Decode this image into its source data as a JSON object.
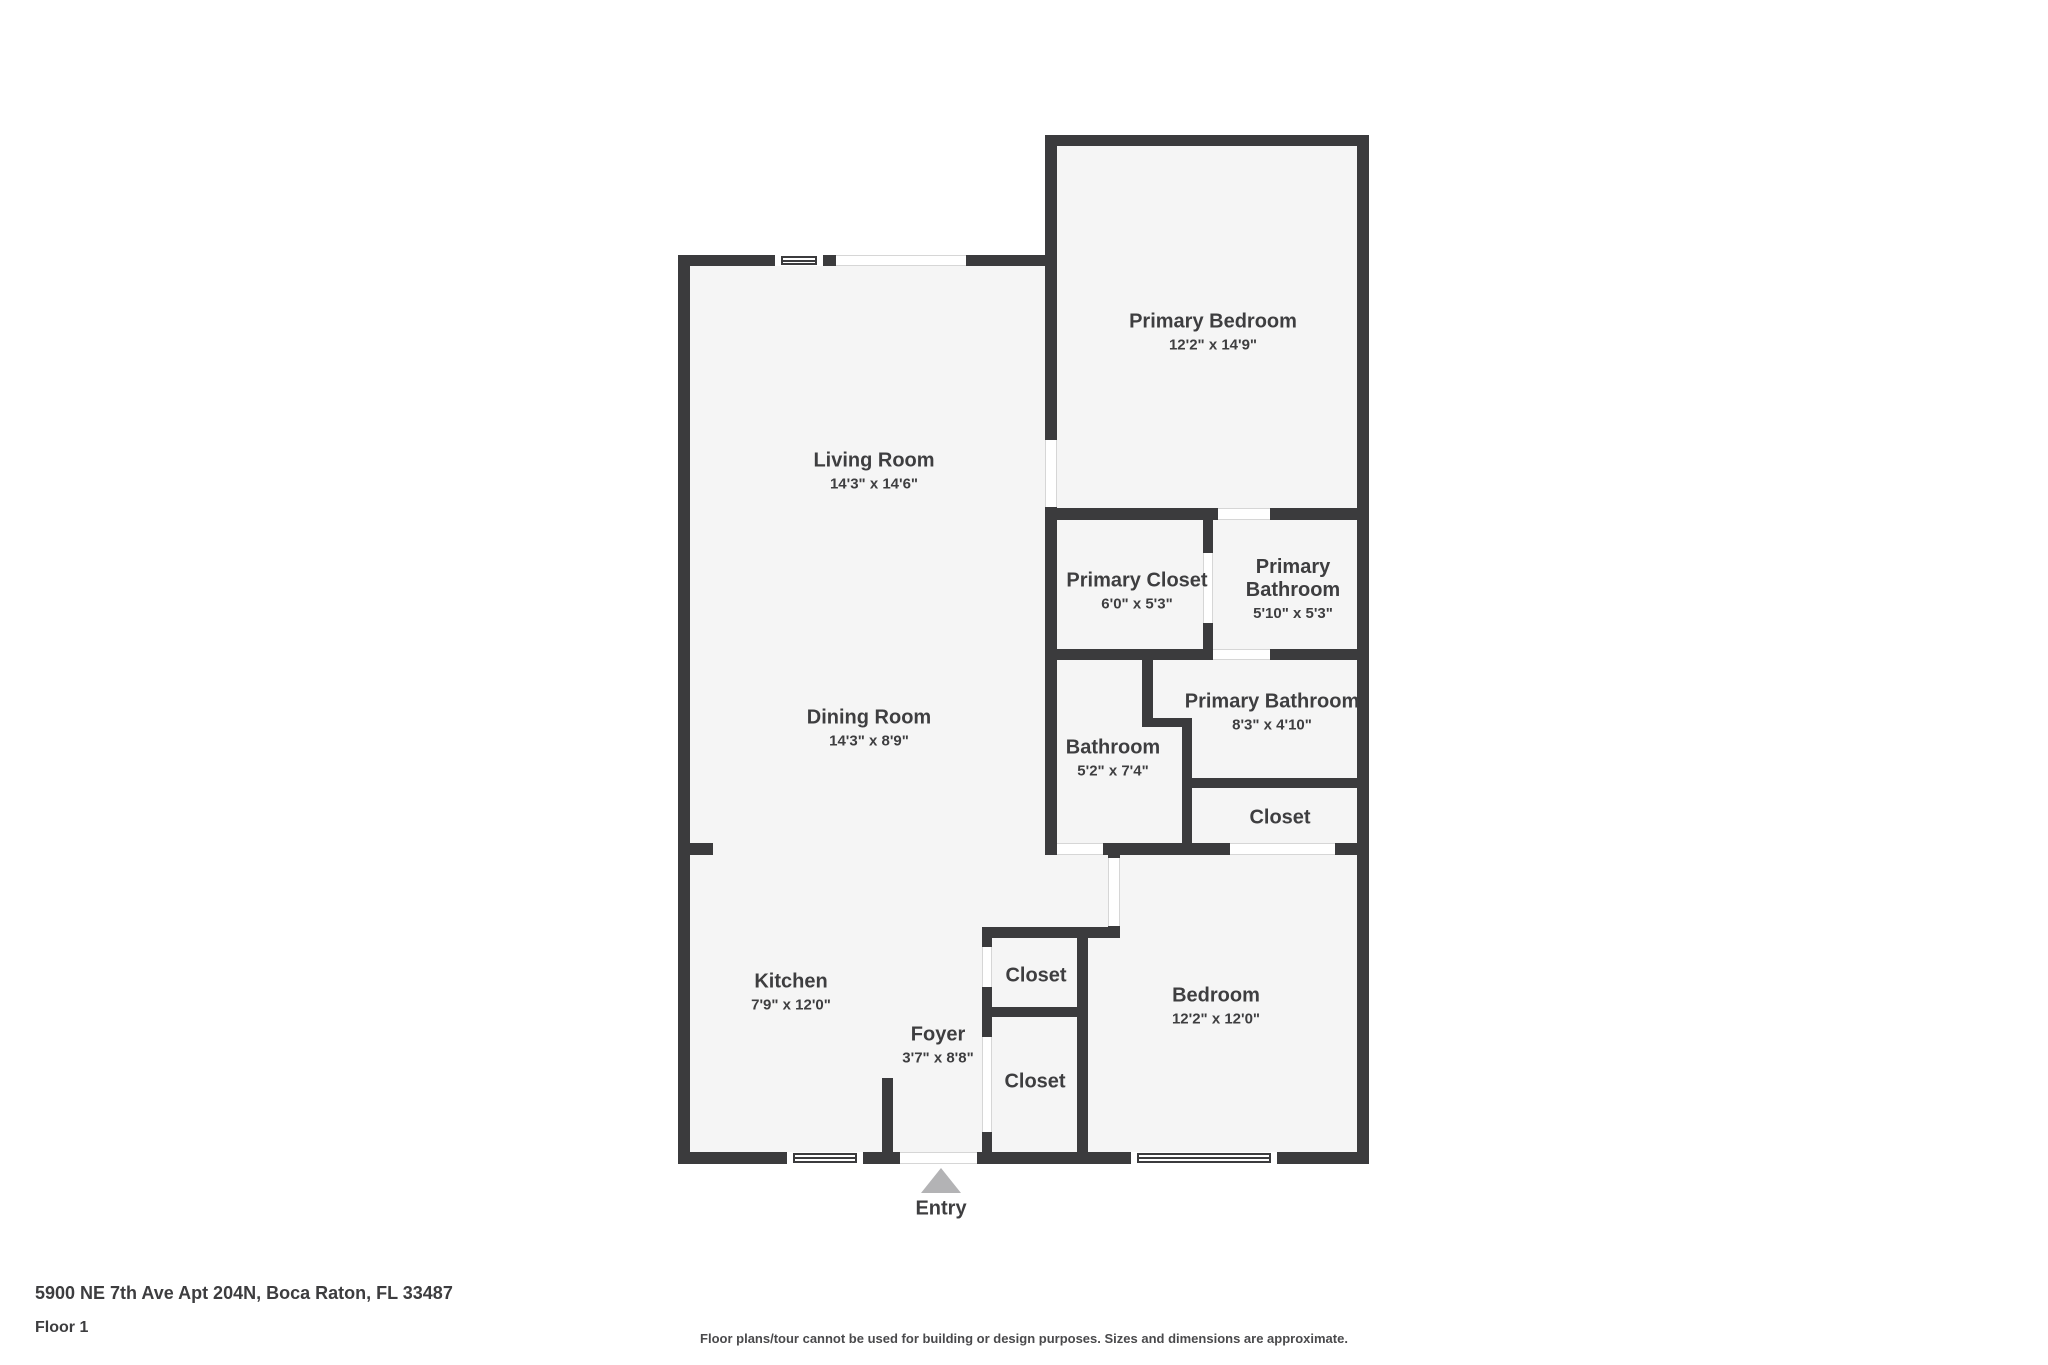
{
  "floorplan": {
    "rooms": [
      {
        "name": "Primary Bedroom",
        "dims": "12'2\" x 14'9\""
      },
      {
        "name": "Living Room",
        "dims": "14'3\" x 14'6\""
      },
      {
        "name": "Primary Closet",
        "dims": "6'0\" x 5'3\""
      },
      {
        "name": "Primary Bathroom",
        "dims": "5'10\" x 5'3\""
      },
      {
        "name": "Primary Bathroom",
        "dims": "8'3\" x 4'10\""
      },
      {
        "name": "Bathroom",
        "dims": "5'2\" x 7'4\""
      },
      {
        "name": "Closet"
      },
      {
        "name": "Dining Room",
        "dims": "14'3\" x 8'9\""
      },
      {
        "name": "Closet"
      },
      {
        "name": "Closet"
      },
      {
        "name": "Bedroom",
        "dims": "12'2\" x 12'0\""
      },
      {
        "name": "Kitchen",
        "dims": "7'9\" x 12'0\""
      },
      {
        "name": "Foyer",
        "dims": "3'7\" x 8'8\""
      }
    ],
    "entry_label": "Entry"
  },
  "footer": {
    "address": "5900 NE 7th Ave Apt 204N, Boca Raton, FL 33487",
    "floor": "Floor 1",
    "disclaimer": "Floor plans/tour cannot be used for building or design purposes. Sizes and dimensions are approximate."
  },
  "colors": {
    "wall": "#3b3b3d",
    "room_fill": "#f5f5f5",
    "label_text": "#3e3e40",
    "entry_arrow": "#b3b3b5"
  }
}
